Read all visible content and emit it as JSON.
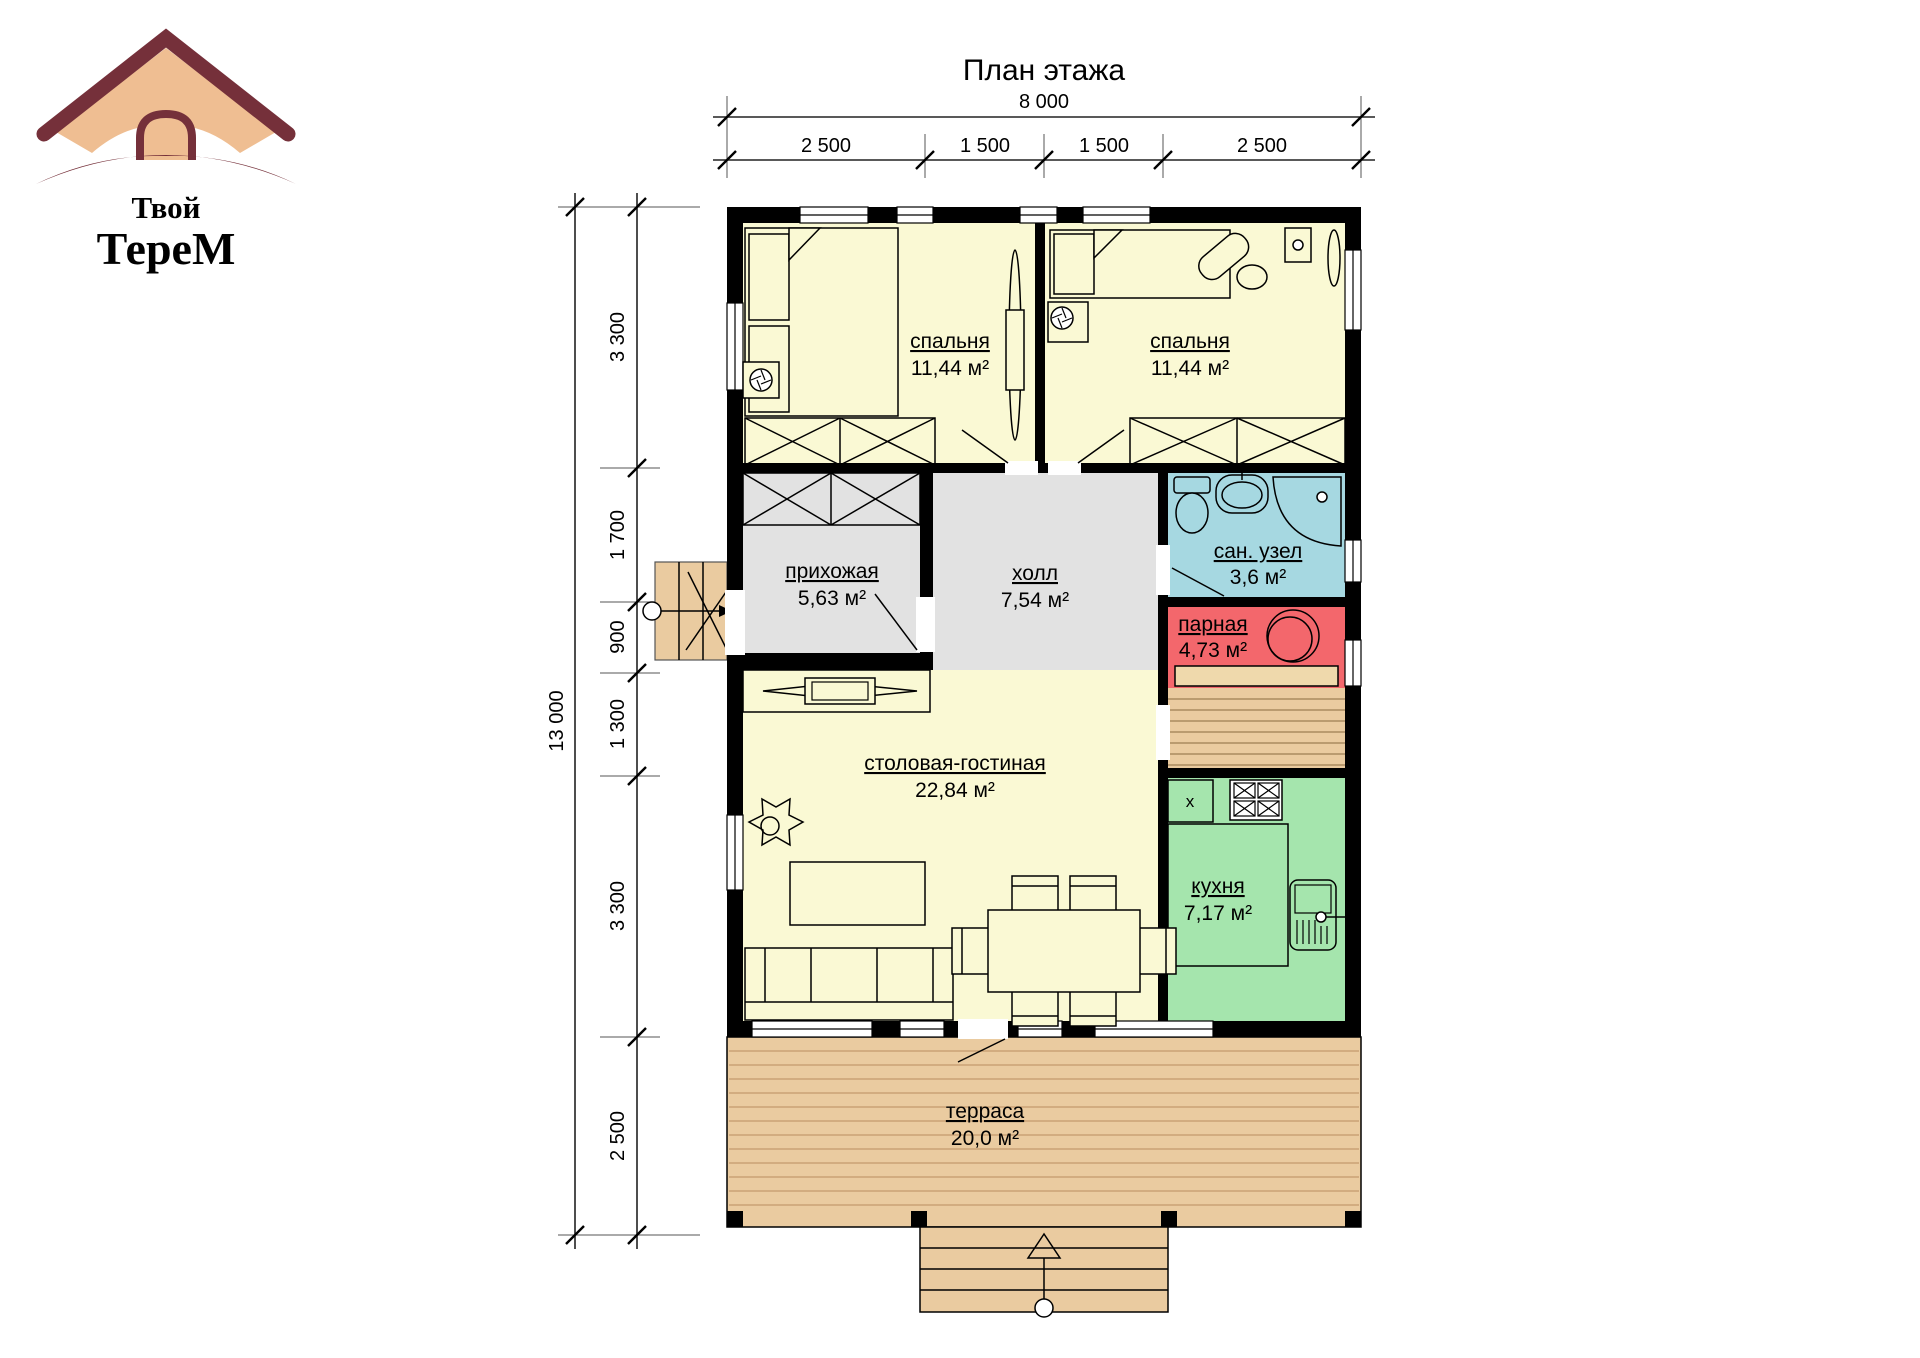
{
  "drawing": {
    "title": "План этажа"
  },
  "logo": {
    "word1": "Твой",
    "word2": "ТереМ",
    "maroon": "#75303A",
    "tan": "#EFBE92"
  },
  "dimensions": {
    "horizontal": {
      "total": "8 000",
      "segments": [
        "2 500",
        "1 500",
        "1 500",
        "2 500"
      ]
    },
    "vertical": {
      "total": "13 000",
      "segments": [
        "3 300",
        "1 700",
        "900",
        "1 300",
        "3 300",
        "2 500"
      ]
    }
  },
  "rooms": [
    {
      "key": "bedroom-left",
      "name": "спальня",
      "area": "11,44 м²",
      "fill": "#FAF9D4"
    },
    {
      "key": "bedroom-right",
      "name": "спальня",
      "area": "11,44 м²",
      "fill": "#FAF9D4"
    },
    {
      "key": "entry-hall",
      "name": "прихожая",
      "area": "5,63 м²",
      "fill": "#E2E2E2"
    },
    {
      "key": "hall",
      "name": "холл",
      "area": "7,54 м²",
      "fill": "#E2E2E2"
    },
    {
      "key": "bathroom",
      "name": "сан. узел",
      "area": "3,6 м²",
      "fill": "#A6D8E1"
    },
    {
      "key": "steam-room",
      "name": "парная",
      "area": "4,73 м²",
      "fill": "#F3676C"
    },
    {
      "key": "living-dining",
      "name": "столовая-гостиная",
      "area": "22,84 м²",
      "fill": "#FAF9D4"
    },
    {
      "key": "kitchen",
      "name": "кухня",
      "area": "7,17 м²",
      "fill": "#A5E5AD"
    },
    {
      "key": "terrace",
      "name": "терраса",
      "area": "20,0 м²",
      "fill": "#EACBA0"
    }
  ],
  "annotations": {
    "fridge_mark": "x"
  }
}
